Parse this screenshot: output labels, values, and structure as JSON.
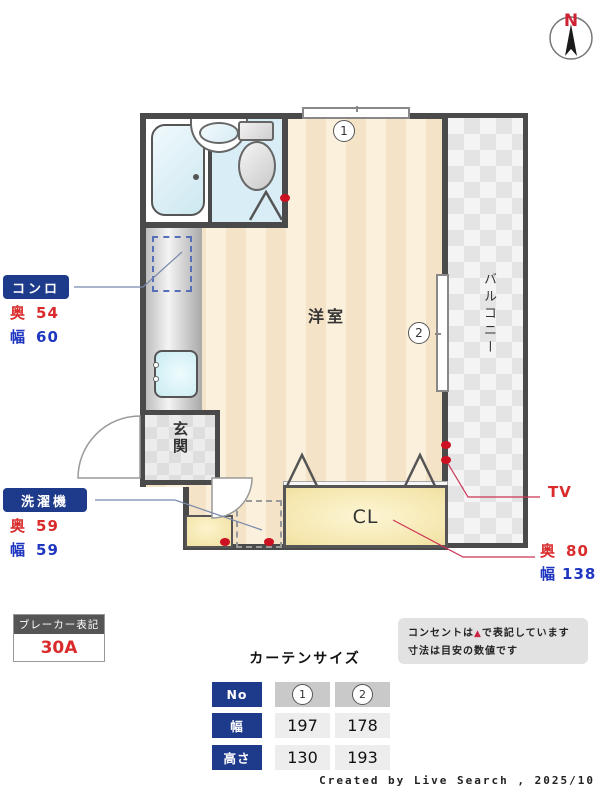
{
  "compass": {
    "label": "N"
  },
  "plan": {
    "room_label": "洋室",
    "entrance_label": "玄関",
    "balcony_label": "バルコニー",
    "closet_label": "CL",
    "window1_num": "1",
    "window2_num": "2",
    "colors": {
      "wall": "#4a4a4a",
      "badge_navy": "#1e3a8a",
      "dim_red": "#d92b2b",
      "dim_blue": "#1f36c0",
      "outlet_red": "#cc1122",
      "room_stripe_dark": "#f4e3c6",
      "room_stripe_light": "#fbf0dc",
      "closet_yellow": "#f5e6ad",
      "bath_blue": "#d9edf6"
    }
  },
  "annotations": {
    "stove": {
      "label": "コンロ",
      "depth_label": "奥",
      "depth": "54",
      "width_label": "幅",
      "width": "60"
    },
    "washer": {
      "label": "洗濯機",
      "depth_label": "奥",
      "depth": "59",
      "width_label": "幅",
      "width": "59"
    },
    "tv": {
      "label": "TV"
    },
    "closet": {
      "depth_label": "奥",
      "depth": "80",
      "width_label": "幅",
      "width": "138"
    }
  },
  "breaker": {
    "title": "ブレーカー表記",
    "value": "30A"
  },
  "note": {
    "line1_before": "コンセントは",
    "line1_icon": "▲",
    "line1_after": "で表記しています",
    "line2": "寸法は目安の数値です"
  },
  "curtain_table": {
    "title": "カーテンサイズ",
    "header_label": "No",
    "cols": [
      "1",
      "2"
    ],
    "rows": [
      {
        "label": "幅",
        "values": [
          "197",
          "178"
        ]
      },
      {
        "label": "高さ",
        "values": [
          "130",
          "193"
        ]
      }
    ]
  },
  "footer": {
    "credit": "Created by Live Search , 2025/10"
  }
}
